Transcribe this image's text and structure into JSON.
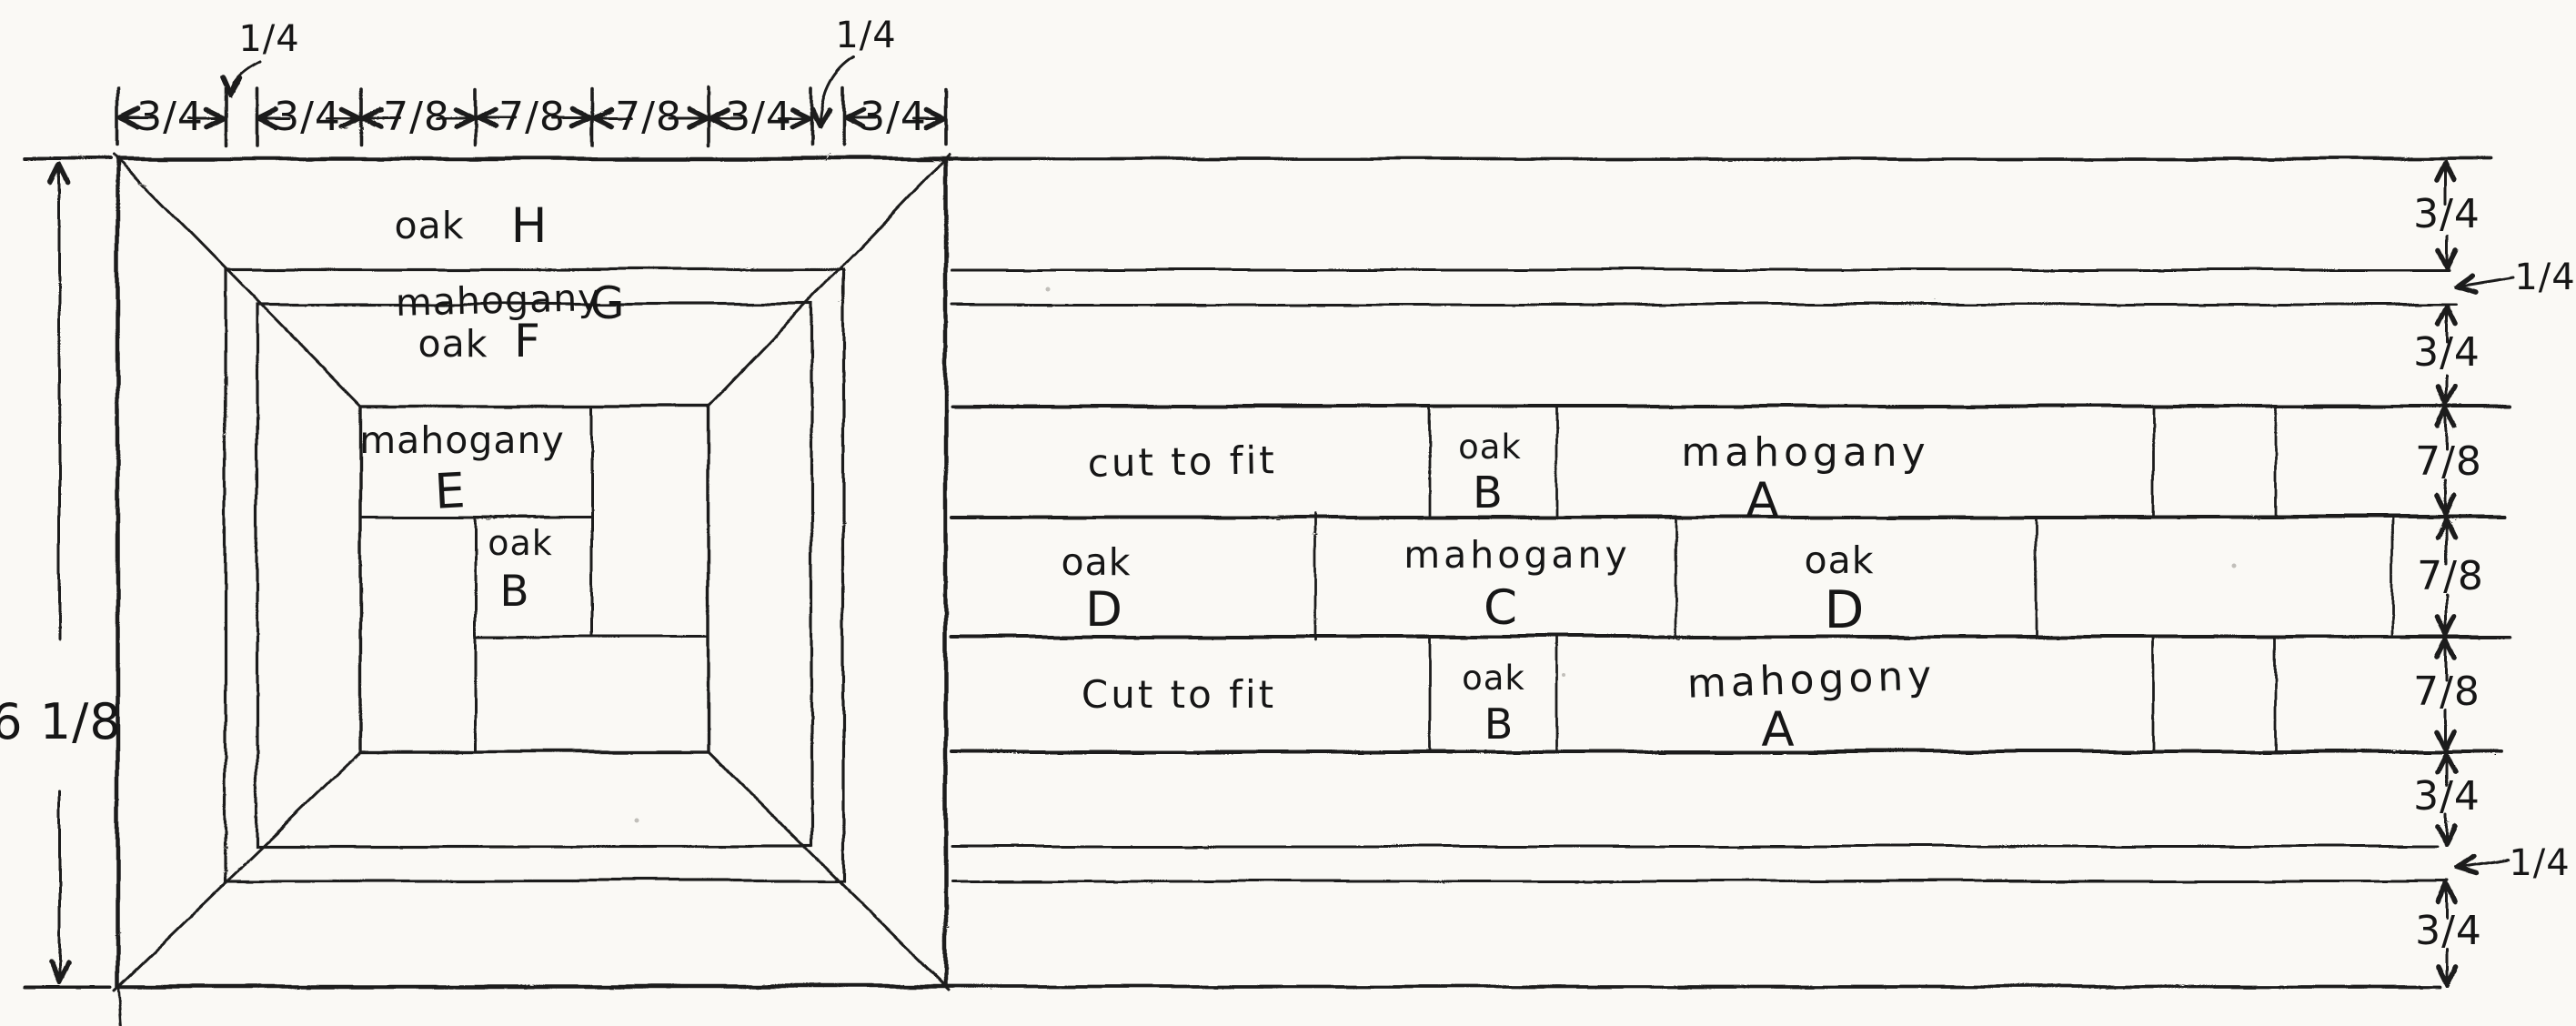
{
  "dims": {
    "overall_height": "6 1/8",
    "top_segments": [
      "3/4",
      "3/4",
      "7/8",
      "7/8",
      "7/8",
      "3/4",
      "3/4"
    ],
    "top_callout_left": "1/4",
    "top_callout_right": "1/4",
    "right_rows": [
      "3/4",
      "1/4",
      "3/4",
      "7/8",
      "7/8",
      "7/8",
      "3/4",
      "1/4",
      "3/4"
    ]
  },
  "square": {
    "h_wood": "oak",
    "h_letter": "H",
    "g_wood": "mahogany",
    "g_letter": "G",
    "f_wood": "oak",
    "f_letter": "F",
    "e_wood": "mahogany",
    "e_letter": "E",
    "b_wood": "oak",
    "b_letter": "B"
  },
  "strips": {
    "r4": {
      "cut": "cut to fit",
      "b_wood": "oak",
      "b_letter": "B",
      "a_wood": "mahogany",
      "a_letter": "A"
    },
    "r5": {
      "d1_wood": "oak",
      "d1_letter": "D",
      "c_wood": "mahogany",
      "c_letter": "C",
      "d2_wood": "oak",
      "d2_letter": "D"
    },
    "r6": {
      "cut": "Cut to fit",
      "b_wood": "oak",
      "b_letter": "B",
      "a_wood": "mahogony",
      "a_letter": "A"
    }
  }
}
